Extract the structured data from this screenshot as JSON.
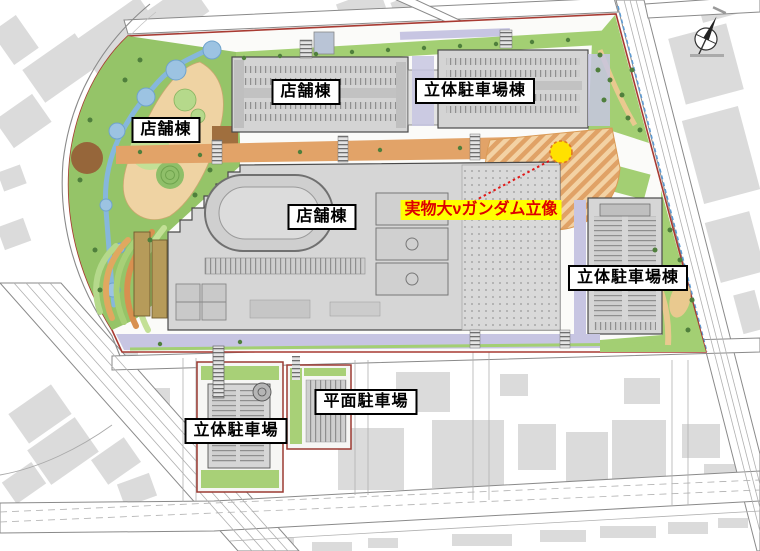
{
  "plan": {
    "labels": {
      "store_nw": "店舗棟",
      "store_north": "店舗棟",
      "parking_deck_north": "立体駐車場棟",
      "store_main": "店舗棟",
      "gundam_statue": "実物大νガンダム立像",
      "parking_deck_east": "立体駐車場棟",
      "parking_deck_south": "立体駐車場",
      "surface_lot_south": "平面駐車場"
    },
    "marker": {
      "statue_fill": "#FFE100",
      "statue_outline": "#E07820",
      "leader_color": "#E01818",
      "label_highlight": "#FFFF00",
      "label_text_color": "#DD0000"
    },
    "colors": {
      "site_boundary": "#A83A32",
      "park_green": "#95C468",
      "grass_green": "#A3CF73",
      "promenade_orange": "#E2A368",
      "water_blue": "#86B7DC",
      "building_gray": "#D6D6D6",
      "service_lavender": "#C7C5E2",
      "city_block_gray": "#DBDBDB"
    },
    "icons": {
      "compass": "north-compass-icon"
    }
  }
}
